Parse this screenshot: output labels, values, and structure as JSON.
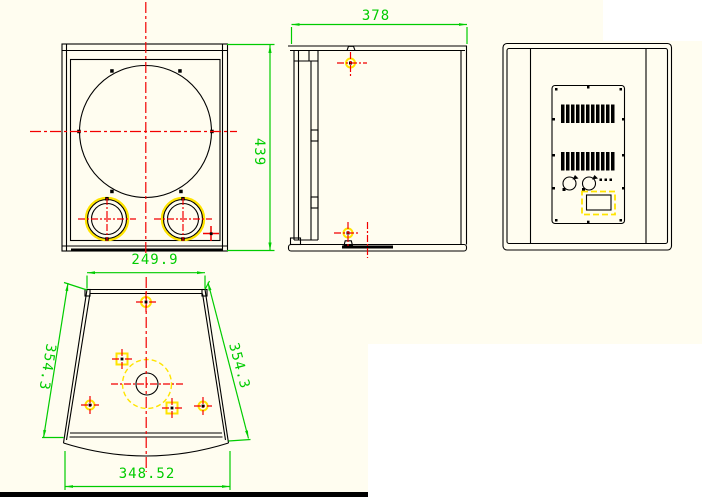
{
  "canvas": {
    "background": "#fffdf0",
    "page_background": "#ffffff",
    "bottom_border_color": "#000000"
  },
  "colors": {
    "line": "#000000",
    "centerline": "#f20000",
    "dimension": "#00cc00",
    "highlight": "#ffe400"
  },
  "dims": {
    "side_depth": "378",
    "front_height": "439",
    "top_back_width": "249.9",
    "left_slant": "354.3",
    "right_slant": "354.3",
    "bottom_front_width": "348.52"
  }
}
